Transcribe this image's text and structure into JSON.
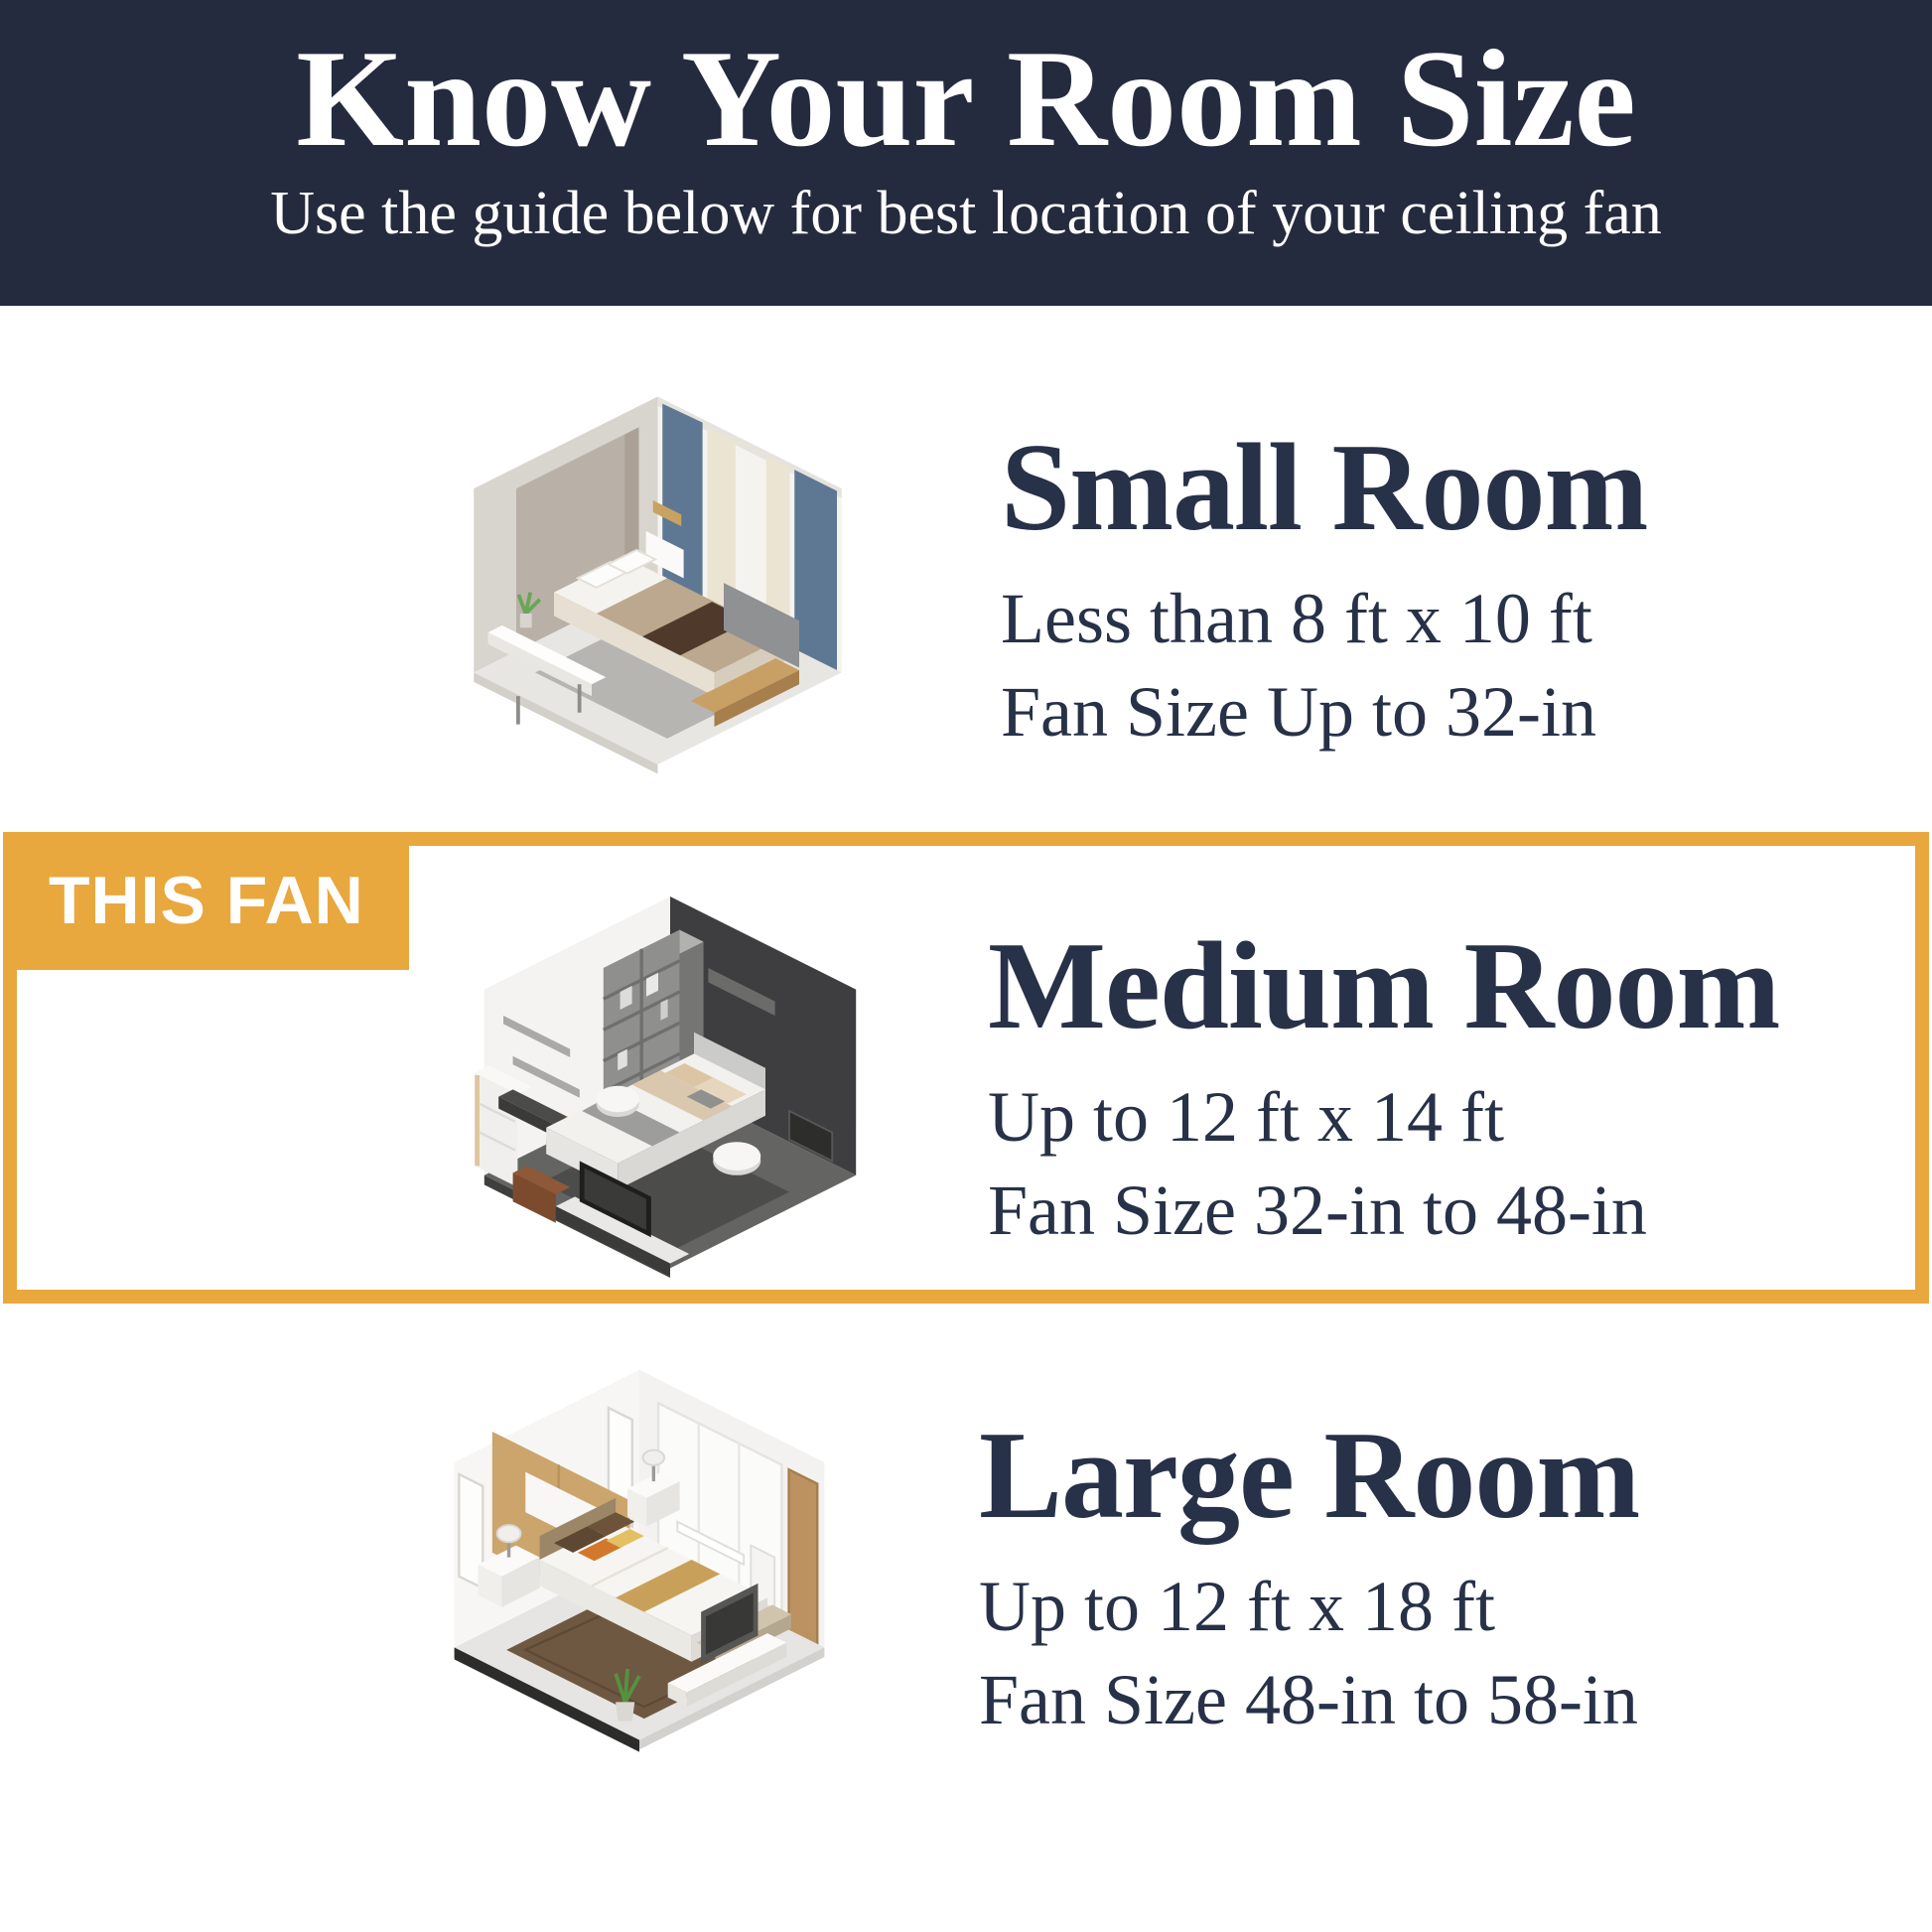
{
  "header": {
    "title": "Know Your Room Size",
    "subtitle": "Use the guide below for best location of your ceiling fan"
  },
  "highlight": {
    "badge_label": "THIS FAN",
    "applies_to": "Medium Room"
  },
  "sections": [
    {
      "key": "small",
      "title": "Small Room",
      "size_range": "Less than 8 ft x 10 ft",
      "fan_size": "Fan Size Up to 32-in",
      "illustration": "small-room-isometric-bedroom",
      "highlighted": false
    },
    {
      "key": "medium",
      "title": "Medium Room",
      "size_range": "Up to 12 ft x 14 ft",
      "fan_size": "Fan Size 32-in to 48-in",
      "illustration": "medium-room-isometric-bedroom",
      "highlighted": true
    },
    {
      "key": "large",
      "title": "Large Room",
      "size_range": "Up to 12 ft x 18 ft",
      "fan_size": "Fan Size 48-in to 58-in",
      "illustration": "large-room-isometric-bedroom",
      "highlighted": false
    }
  ],
  "colors": {
    "header_background": "#252b3e",
    "accent_orange": "#e8a83e",
    "text_navy": "#273148",
    "page_background": "#ffffff",
    "header_text": "#ffffff"
  }
}
